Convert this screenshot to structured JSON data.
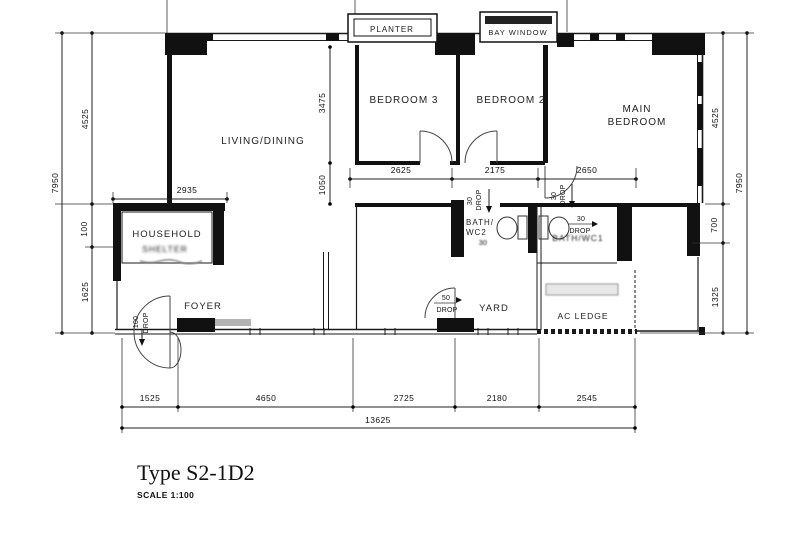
{
  "title": "Type S2-1D2",
  "scale_label": "SCALE 1:100",
  "rooms": {
    "living_dining": "LIVING/DINING",
    "bedroom3": "BEDROOM 3",
    "bedroom2": "BEDROOM 2",
    "main_bedroom_line1": "MAIN",
    "main_bedroom_line2": "BEDROOM",
    "household": "HOUSEHOLD",
    "household_shelter": "SHELTER",
    "foyer": "FOYER",
    "bath_wc2_line1": "BATH/",
    "bath_wc2_line2": "WC2",
    "bath_wc1": "BATH/WC1",
    "yard": "YARD",
    "ac_ledge": "AC LEDGE"
  },
  "features": {
    "planter": "PLANTER",
    "bay_window": "BAY WINDOW"
  },
  "dimensions": {
    "left_overall": "7950",
    "left_upper": "4525",
    "left_mid": "100",
    "left_lower": "1625",
    "household_width": "2935",
    "bedroom3_depth": "3475",
    "corridor_depth": "1050",
    "mid_seg1": "2625",
    "mid_seg2": "2175",
    "mid_seg3": "2650",
    "right_upper": "4525",
    "right_mid": "700",
    "right_lower": "1325",
    "right_overall": "7950",
    "bottom_seg1": "1525",
    "bottom_seg2": "4650",
    "bottom_seg3": "2725",
    "bottom_seg4": "2180",
    "bottom_seg5": "2545",
    "bottom_overall": "13625"
  },
  "drops": {
    "bath_wc2_step": "30",
    "bath_wc1_step": "30",
    "bath_wc1_inner_step": "30",
    "wc2_inner_step": "30",
    "yard_step": "50",
    "entrance_step": "100",
    "drop_word": "DROP"
  }
}
